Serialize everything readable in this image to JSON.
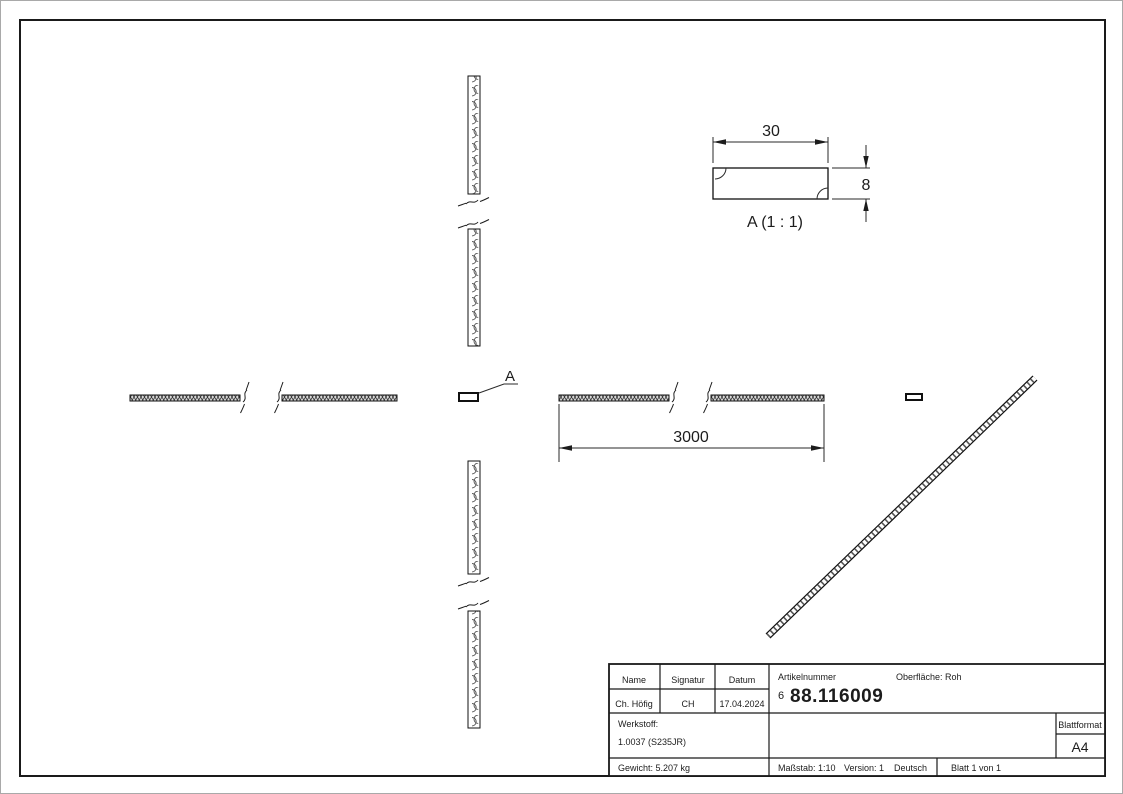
{
  "drawing": {
    "detail_label": "A (1 : 1)",
    "detail_width_dim": "30",
    "detail_height_dim": "8",
    "length_dim": "3000",
    "section_marker": "A"
  },
  "title_block": {
    "col_name": "Name",
    "col_signatur": "Signatur",
    "col_datum": "Datum",
    "name": "Ch. Höfig",
    "signatur": "CH",
    "datum": "17.04.2024",
    "artikelnummer_label": "Artikelnummer",
    "artikelnummer_prefix": "6",
    "artikelnummer": "88.116009",
    "oberflaeche_label": "Oberfläche:",
    "oberflaeche_value": "Roh",
    "werkstoff_label": "Werkstoff:",
    "werkstoff_value": "1.0037 (S235JR)",
    "gewicht": "Gewicht: 5.207 kg",
    "massstab": "Maßstab: 1:10",
    "version": "Version: 1",
    "sprache": "Deutsch",
    "blatt": "Blatt 1 von 1",
    "blattformat_label": "Blattformat",
    "blattformat_value": "A4"
  }
}
